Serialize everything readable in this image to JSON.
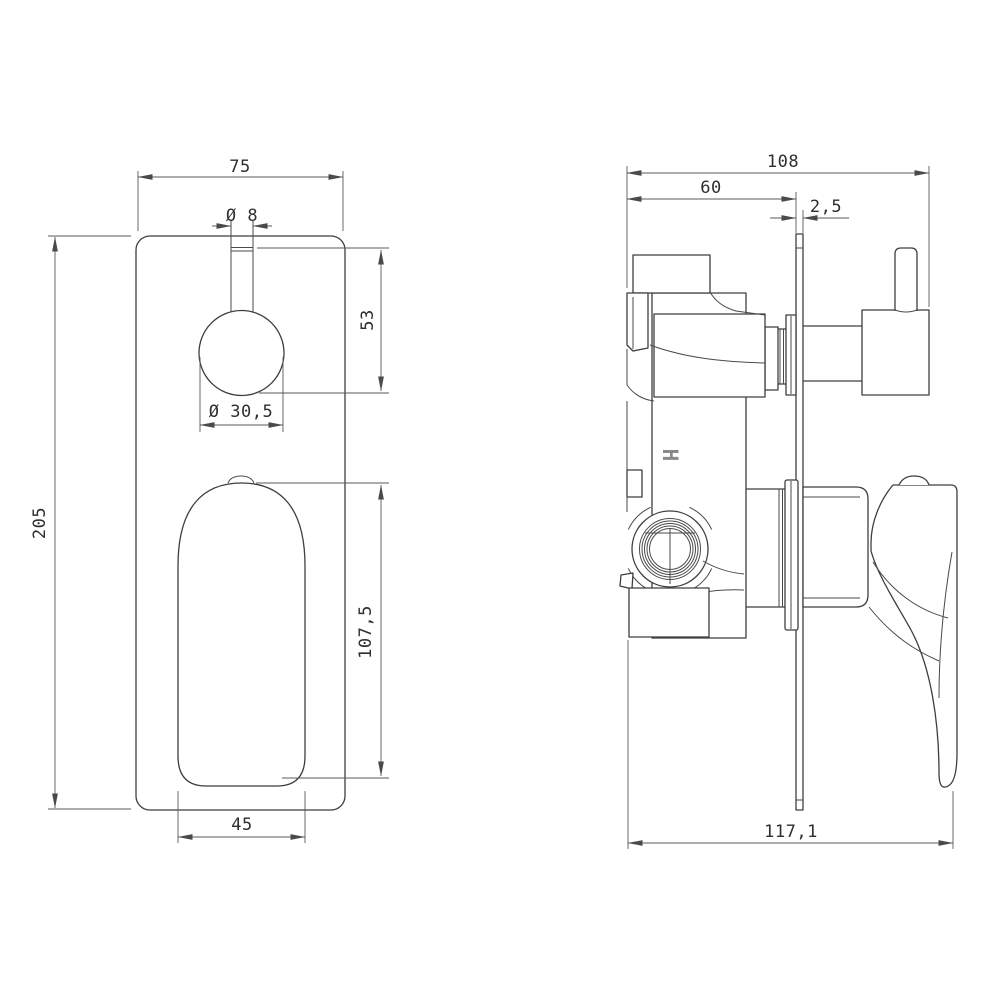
{
  "front_view": {
    "dim_plate_width": "75",
    "dim_stem_diameter": "Ø 8",
    "dim_knob_drop": "53",
    "dim_knob_diameter": "Ø 30,5",
    "dim_plate_height": "205",
    "dim_handle_length": "107,5",
    "dim_handle_width": "45"
  },
  "side_view": {
    "dim_overall_depth": "108",
    "dim_body_depth": "60",
    "dim_plate_thickness": "2,5",
    "dim_total_depth": "117,1",
    "body_mark": "H"
  },
  "colors": {
    "outline": "#3e3e3e",
    "dimension": "#5a5a5a",
    "text": "#2e2e2e",
    "mark": "#8a8a8a",
    "background": "#ffffff"
  }
}
